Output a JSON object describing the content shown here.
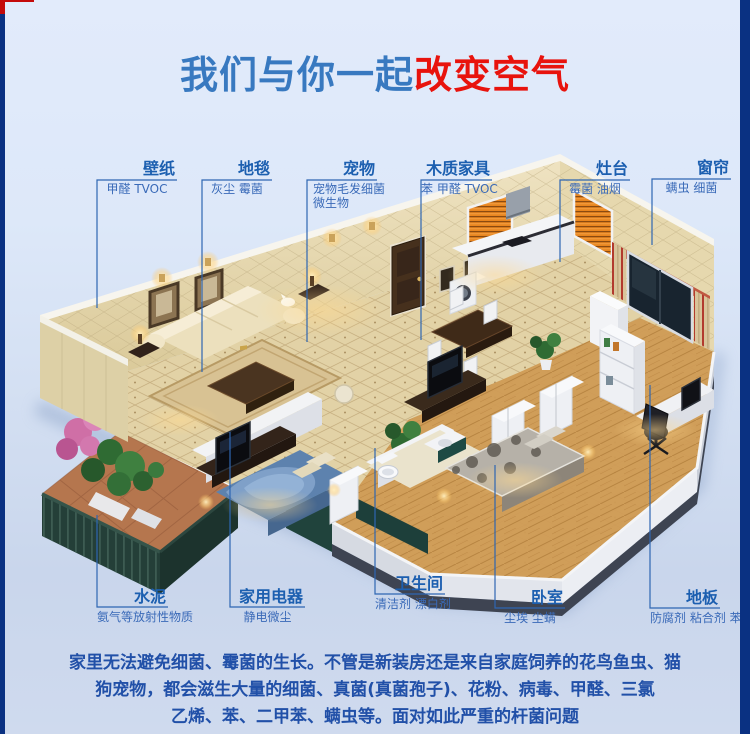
{
  "title": {
    "blue_part": "我们与你一起",
    "red_part": "改变空气"
  },
  "colors": {
    "accent_blue": "#3879c0",
    "accent_red": "#e8130d",
    "label_title": "#1c5fb0",
    "label_sub": "#3a6ab8",
    "leader_line": "#2e66b2",
    "paragraph": "#2150a8",
    "border_navy": "#0a3182",
    "border_red": "#c40a0a",
    "wall_cream": "#e8dcb4",
    "floor_tile": "#e2d2a6",
    "floor_wood": "#cf9b55",
    "kitchen_orange": "#e8851f"
  },
  "labels": {
    "top": [
      {
        "id": "wallpaper",
        "title": "壁纸",
        "sub": "甲醛 TVOC"
      },
      {
        "id": "carpet",
        "title": "地毯",
        "sub": "灰尘 霉菌"
      },
      {
        "id": "pets",
        "title": "宠物",
        "sub": "宠物毛发细菌",
        "sub2": "微生物"
      },
      {
        "id": "wood-furniture",
        "title": "木质家具",
        "sub": "苯 甲醛 TVOC"
      },
      {
        "id": "stove",
        "title": "灶台",
        "sub": "霉菌 油烟"
      },
      {
        "id": "curtain",
        "title": "窗帘",
        "sub": "螨虫 细菌"
      }
    ],
    "bottom": [
      {
        "id": "cement",
        "title": "水泥",
        "sub": "氨气等放射性物质"
      },
      {
        "id": "appliances",
        "title": "家用电器",
        "sub": "静电微尘"
      },
      {
        "id": "bathroom",
        "title": "卫生间",
        "sub": "清洁剂 漂白剂"
      },
      {
        "id": "bedroom",
        "title": "卧室",
        "sub": "尘埃 尘螨"
      },
      {
        "id": "floor",
        "title": "地板",
        "sub": "防腐剂 粘合剂 苯 甲醛"
      }
    ]
  },
  "paragraph": {
    "line1": "家里无法避免细菌、霉菌的生长。不管是新装房还是来自家庭饲养的花鸟鱼虫、猫",
    "line2": "狗宠物，都会滋生大量的细菌、真菌(真菌孢子)、花粉、病毒、甲醛、三氯",
    "line3": "乙烯、苯、二甲苯、螨虫等。面对如此严重的杆菌问题"
  }
}
